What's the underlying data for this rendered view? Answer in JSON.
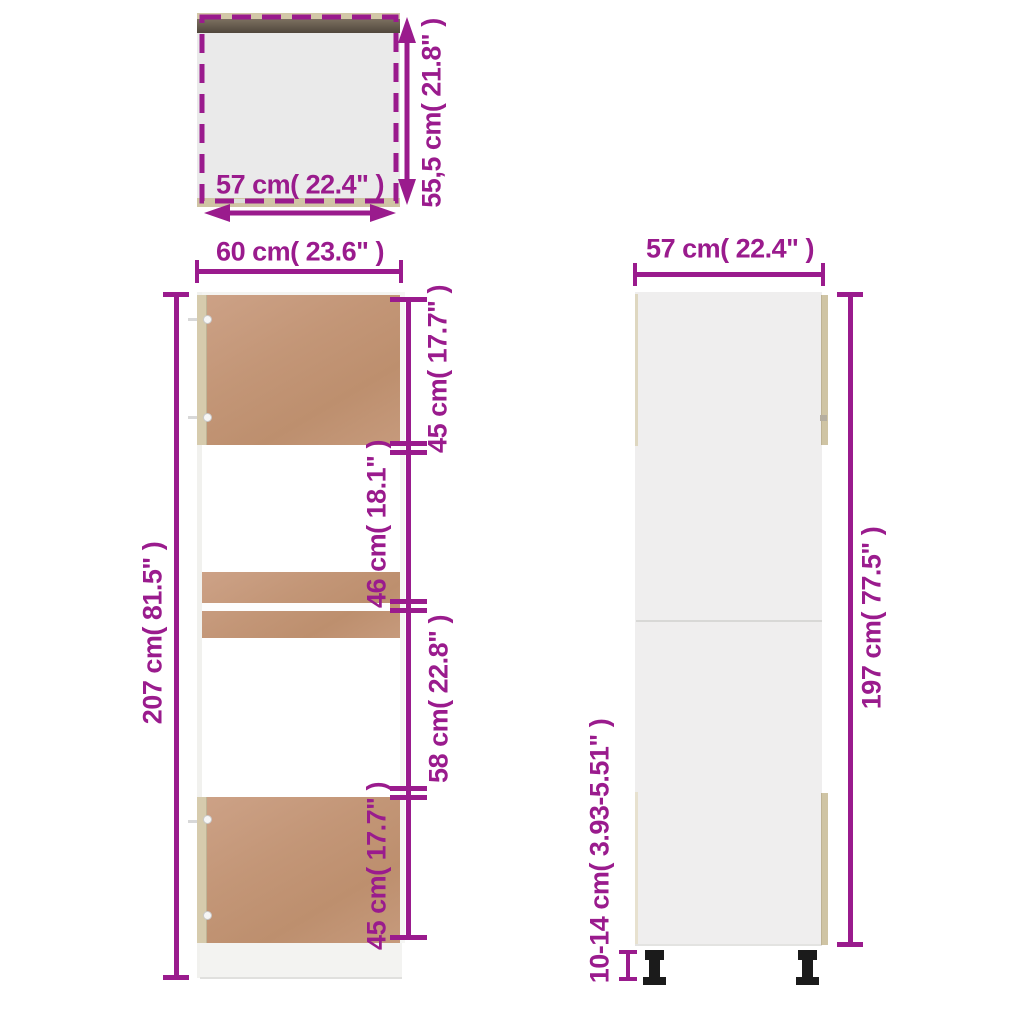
{
  "accent_color": "#9a1b8d",
  "materials": {
    "door_color": "#c59872",
    "edge_color": "#cfc4a4",
    "top_panel_dark_color": "#5e5446",
    "carcass_gray_color": "#eeeeee",
    "leg_color": "#1b1b1b"
  },
  "top_view": {
    "width": "57 cm( 22.4\" )",
    "depth": "55,5 cm( 21.8\" )"
  },
  "front_view": {
    "width": "60 cm( 23.6\" )",
    "height": "207 cm( 81.5\" )",
    "segments": [
      "45 cm( 17.7\" )",
      "46 cm( 18.1\" )",
      "58 cm( 22.8\" )",
      "45 cm( 17.7\" )"
    ]
  },
  "side_view": {
    "width": "57 cm( 22.4\" )",
    "height": "197 cm( 77.5\" )",
    "leg_height": "10-14 cm( 3.93-5.51\" )"
  }
}
